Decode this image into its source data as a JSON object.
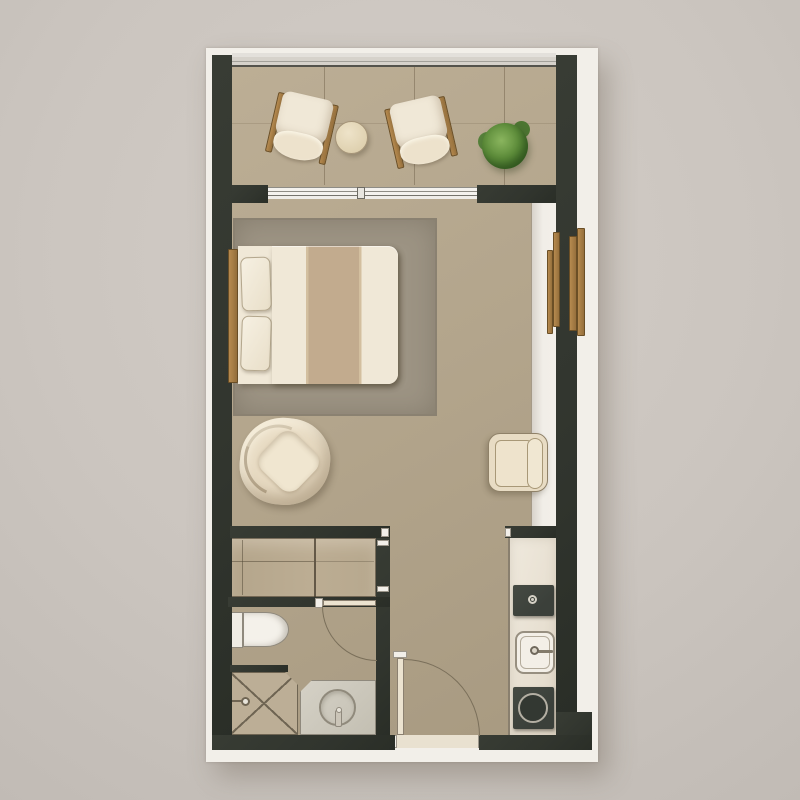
{
  "title": "Studio apartment floor plan (top-down architectural rendering, no text labels)",
  "plan": {
    "type": "studio-apartment-floor-plan",
    "rooms": [
      {
        "name": "Balcony",
        "position": "top",
        "items": [
          "lounge chair with wood arms (left, tilted clockwise)",
          "lounge chair with wood arms (right, tilted counter-clockwise)",
          "round side table",
          "potted plant"
        ],
        "features": [
          "glass railing along top edge",
          "tiled floor",
          "sliding glass door to living area"
        ]
      },
      {
        "name": "Living / sleeping area",
        "position": "center",
        "items": [
          "double bed with wood headboard",
          "two pillows",
          "duvet with tan center runner",
          "large area rug",
          "organic swivel armchair",
          "cube armchair",
          "wardrobe niche with wooden handle battens on right wall"
        ]
      },
      {
        "name": "Closet",
        "position": "lower-left",
        "items": [
          "sliding-door wardrobe with two panels"
        ]
      },
      {
        "name": "Bathroom",
        "position": "bottom-left",
        "items": [
          "toilet with tank",
          "walk-in shower with X floor marking and corner valve",
          "vanity counter with round basin and faucet",
          "door swinging inward"
        ]
      },
      {
        "name": "Kitchenette",
        "position": "bottom-right",
        "items": [
          "counter strip",
          "built-in dark appliance with small knob",
          "square sink with faucet",
          "single round burner cooktop"
        ]
      },
      {
        "name": "Entry",
        "position": "bottom-center",
        "items": [
          "entry door leaf with quarter-circle swing arc",
          "light threshold in wall opening"
        ]
      }
    ],
    "wall_style": "thick very dark gray-green poché",
    "background": "plain warm gray mat with soft drop shadow under plan"
  },
  "palette": {
    "bg": "#cbc5bf",
    "bg-light": "#d3cdc7",
    "bg-dark": "#c1bbb5",
    "wall": "#31352e",
    "paper": "#f2efe9",
    "floor-a": "#bcae95",
    "floor-b": "#b3a58c",
    "floor-c": "#a89a81",
    "rug": "#9d9484",
    "rug-edge": "#8a8171",
    "uph": "#f0e8d7",
    "uph-edge": "#9c8e75",
    "tan": "#c2ab8e",
    "wood-a": "#b68a4f",
    "wood-b": "#96703c",
    "wood-edge": "#6b4f26",
    "glass": "#d6d2cb",
    "counter": "#ece5d9",
    "appliance": "#3b403a",
    "plant": "#5d8c3a",
    "arc": "#7a6f5a",
    "line-strong": "#6f6553"
  }
}
